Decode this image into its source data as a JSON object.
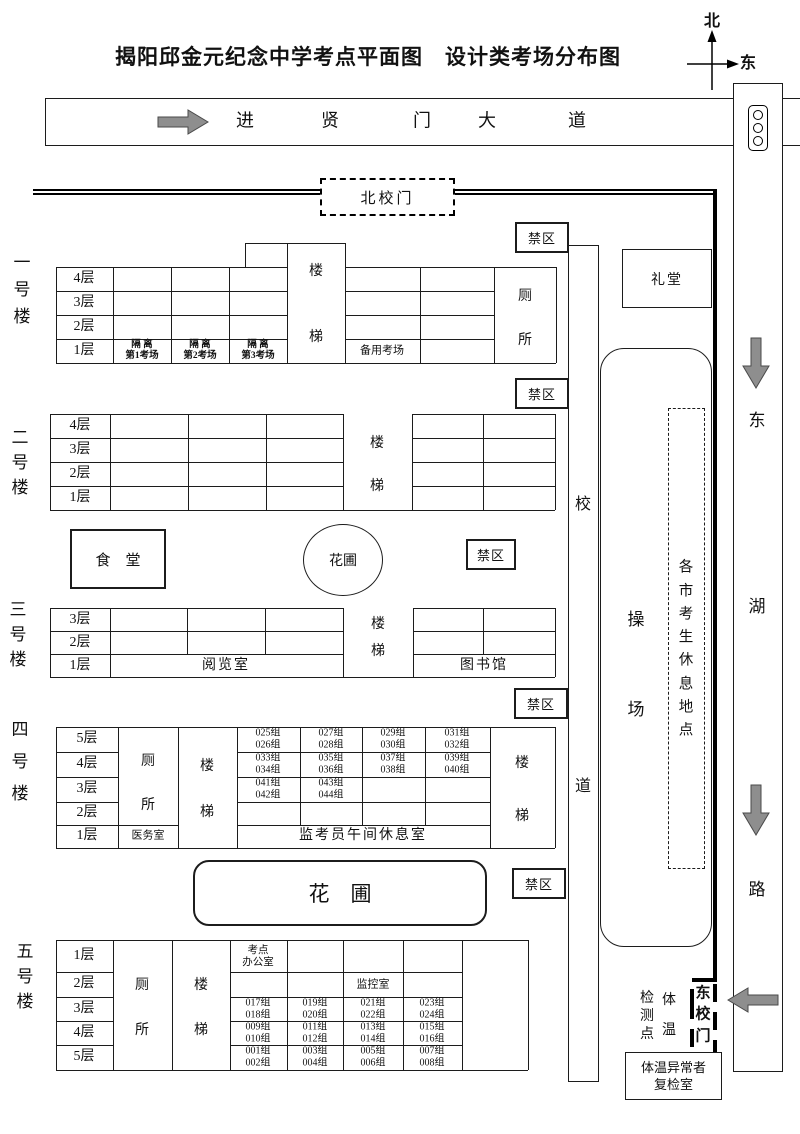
{
  "title": "揭阳邱金元纪念中学考点平面图　设计类考场分布图",
  "compass": {
    "north": "北",
    "east": "东"
  },
  "top_road": {
    "chars": [
      "进",
      "贤",
      "门",
      "大",
      "道"
    ]
  },
  "north_gate": "北校门",
  "forbidden": "禁区",
  "auditorium": "礼堂",
  "canteen": "食　堂",
  "garden_circle": "花圃",
  "garden_rect": "花　圃",
  "campus_road": [
    "校",
    "道"
  ],
  "playground": [
    "操",
    "场"
  ],
  "rest_area": [
    "各",
    "市",
    "考",
    "生",
    "休",
    "息",
    "地",
    "点"
  ],
  "east_road": [
    "东",
    "湖",
    "路"
  ],
  "east_gate": [
    "东",
    "校",
    "门"
  ],
  "temp_check": {
    "left": [
      "检",
      "测",
      "点"
    ],
    "right": [
      "体",
      "温"
    ]
  },
  "recheck_room": "体温异常者\n复检室",
  "b1": {
    "label": [
      "一",
      "号",
      "楼"
    ],
    "floors": [
      "4层",
      "3层",
      "2层",
      "1层"
    ],
    "stairs": [
      "楼",
      "梯"
    ],
    "toilet": [
      "厕",
      "所"
    ],
    "iso1": "隔 离\n第1考场",
    "iso2": "隔 离\n第2考场",
    "iso3": "隔 离\n第3考场",
    "backup": "备用考场"
  },
  "b2": {
    "label": [
      "二",
      "号",
      "楼"
    ],
    "floors": [
      "4层",
      "3层",
      "2层",
      "1层"
    ],
    "stairs": [
      "楼",
      "梯"
    ]
  },
  "b3": {
    "label": [
      "三",
      "号",
      "楼"
    ],
    "floors": [
      "3层",
      "2层",
      "1层"
    ],
    "stairs": [
      "楼",
      "梯"
    ],
    "reading": "阅览室",
    "library": "图书馆"
  },
  "b4": {
    "label": [
      "四",
      "号",
      "楼"
    ],
    "floors": [
      "5层",
      "4层",
      "3层",
      "2层",
      "1层"
    ],
    "toilet": [
      "厕",
      "所"
    ],
    "stairs": [
      "楼",
      "梯"
    ],
    "stairs2": [
      "楼",
      "梯"
    ],
    "medical": "医务室",
    "lunch": "监考员午间休息室",
    "g5": [
      "025组\n026组",
      "027组\n028组",
      "029组\n030组",
      "031组\n032组"
    ],
    "g4": [
      "033组\n034组",
      "035组\n036组",
      "037组\n038组",
      "039组\n040组"
    ],
    "g3": [
      "041组\n042组",
      "043组\n044组"
    ]
  },
  "b5": {
    "label": [
      "五",
      "号",
      "楼"
    ],
    "floors": [
      "1层",
      "2层",
      "3层",
      "4层",
      "5层"
    ],
    "toilet": [
      "厕",
      "所"
    ],
    "stairs": [
      "楼",
      "梯"
    ],
    "stairs2": [
      "楼",
      "梯"
    ],
    "office": "考点\n办公室",
    "monitor": "监控室",
    "g3": [
      "017组\n018组",
      "019组\n020组",
      "021组\n022组",
      "023组\n024组"
    ],
    "g4": [
      "009组\n010组",
      "011组\n012组",
      "013组\n014组",
      "015组\n016组"
    ],
    "g5": [
      "001组\n002组",
      "003组\n004组",
      "005组\n006组",
      "007组\n008组"
    ]
  }
}
